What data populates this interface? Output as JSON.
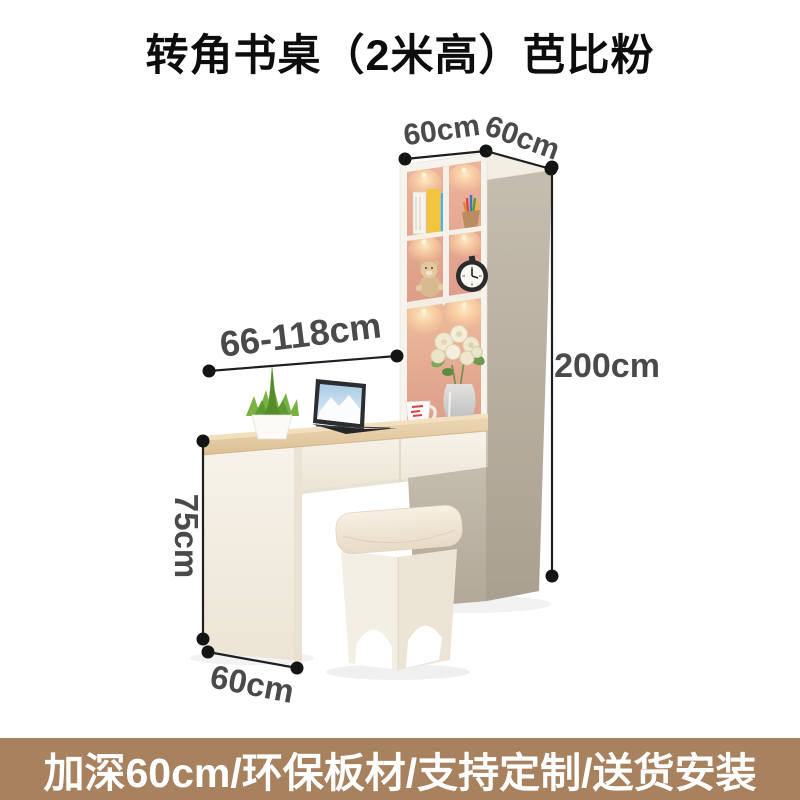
{
  "header": {
    "title": "转角书桌（2米高）芭比粉"
  },
  "dimensions": {
    "cabinet_top_width": "60cm",
    "cabinet_top_depth": "60cm",
    "desk_width_range": "66-118cm",
    "cabinet_height": "200cm",
    "desk_height": "75cm",
    "desk_depth": "60cm"
  },
  "scene_objects": [
    "tall-bookshelf-cabinet-with-pink-interior",
    "led-shelf-lights",
    "books",
    "pencil-cup",
    "teddy-bear",
    "alarm-clock",
    "flower-bouquet-in-glass-vase",
    "white-mug",
    "wood-top-desk-with-two-drawers",
    "succulent-plant-in-white-pot",
    "open-laptop",
    "cream-stool-with-cushion"
  ],
  "footer": {
    "banner_text": "加深60cm/环保板材/支持定制/送货安装"
  },
  "colors": {
    "banner_bg": "#a8815f",
    "title_text": "#0d0d0d",
    "dimension_text": "#4a4a4a",
    "dimension_line": "#1f1f1f",
    "pink_interior": "#e0a18d",
    "cabinet_side_greige": "#b9b0a1",
    "cream_panel": "#f3eede",
    "wood_top": "#e5cca6",
    "shelf_glow": "#ffd9a6"
  }
}
